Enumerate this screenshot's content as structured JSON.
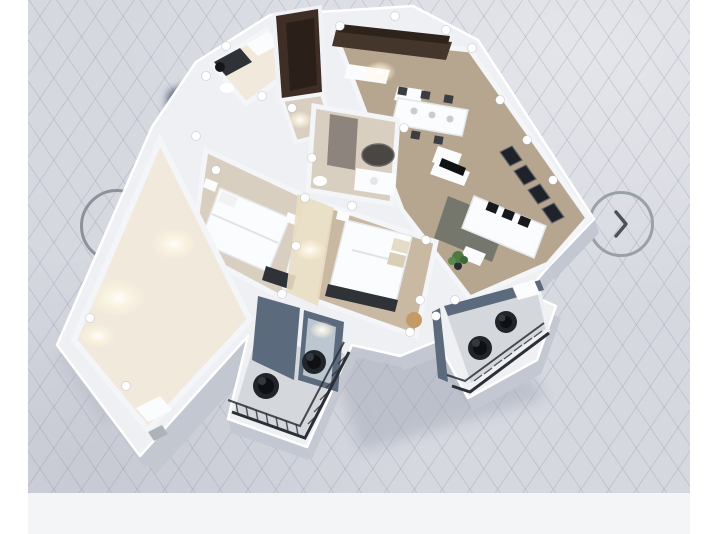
{
  "app": {
    "title": "3D floor plan viewer",
    "description": "Isometric 3D render of an apartment floor plan displayed on a light diagonal-grid drafting canvas with previous and next carousel arrows"
  },
  "carousel": {
    "prev": {
      "label": "Previous view",
      "icon": "chevron-left-icon"
    },
    "next": {
      "label": "Next view",
      "icon": "chevron-right-icon"
    }
  },
  "viewport": {
    "type": "3d-floorplan-canvas",
    "grid": "diagonal-crosshatch"
  },
  "colors": {
    "margin": "#ffffff",
    "canvas_bg": "#d6d8e0",
    "grid_line": "#b7bac9",
    "bottom_band": "#f4f5f7",
    "shadow": "#4c5a72",
    "soft_shadow": "#9aa1ae",
    "wall_top": "#eef0f4",
    "wall_face": "#c2c7d0",
    "wall_inner": "#8e8880",
    "floor_warm": "#f1e9dc",
    "floor_tan": "#b7a68f",
    "floor_beige": "#d9cfc0",
    "floor_taupe": "#c9b9a2",
    "balcony_floor": "#d4d7dc",
    "railing": "#2c3036",
    "furniture_dark": "#2f3236",
    "door_wood": "#3e2e25",
    "cabinet_wood": "#45362b",
    "white_furniture": "#fbfcfd",
    "window_glass": "#1f2228",
    "plant_green": "#4b7a42",
    "glass": "#cdd6df",
    "blue_wall": "#5c6a7d",
    "ring": "#8d9199",
    "chevron_left": "#1d1f24",
    "chevron_right": "#4e5158",
    "light_glow": "#fff7e0"
  }
}
